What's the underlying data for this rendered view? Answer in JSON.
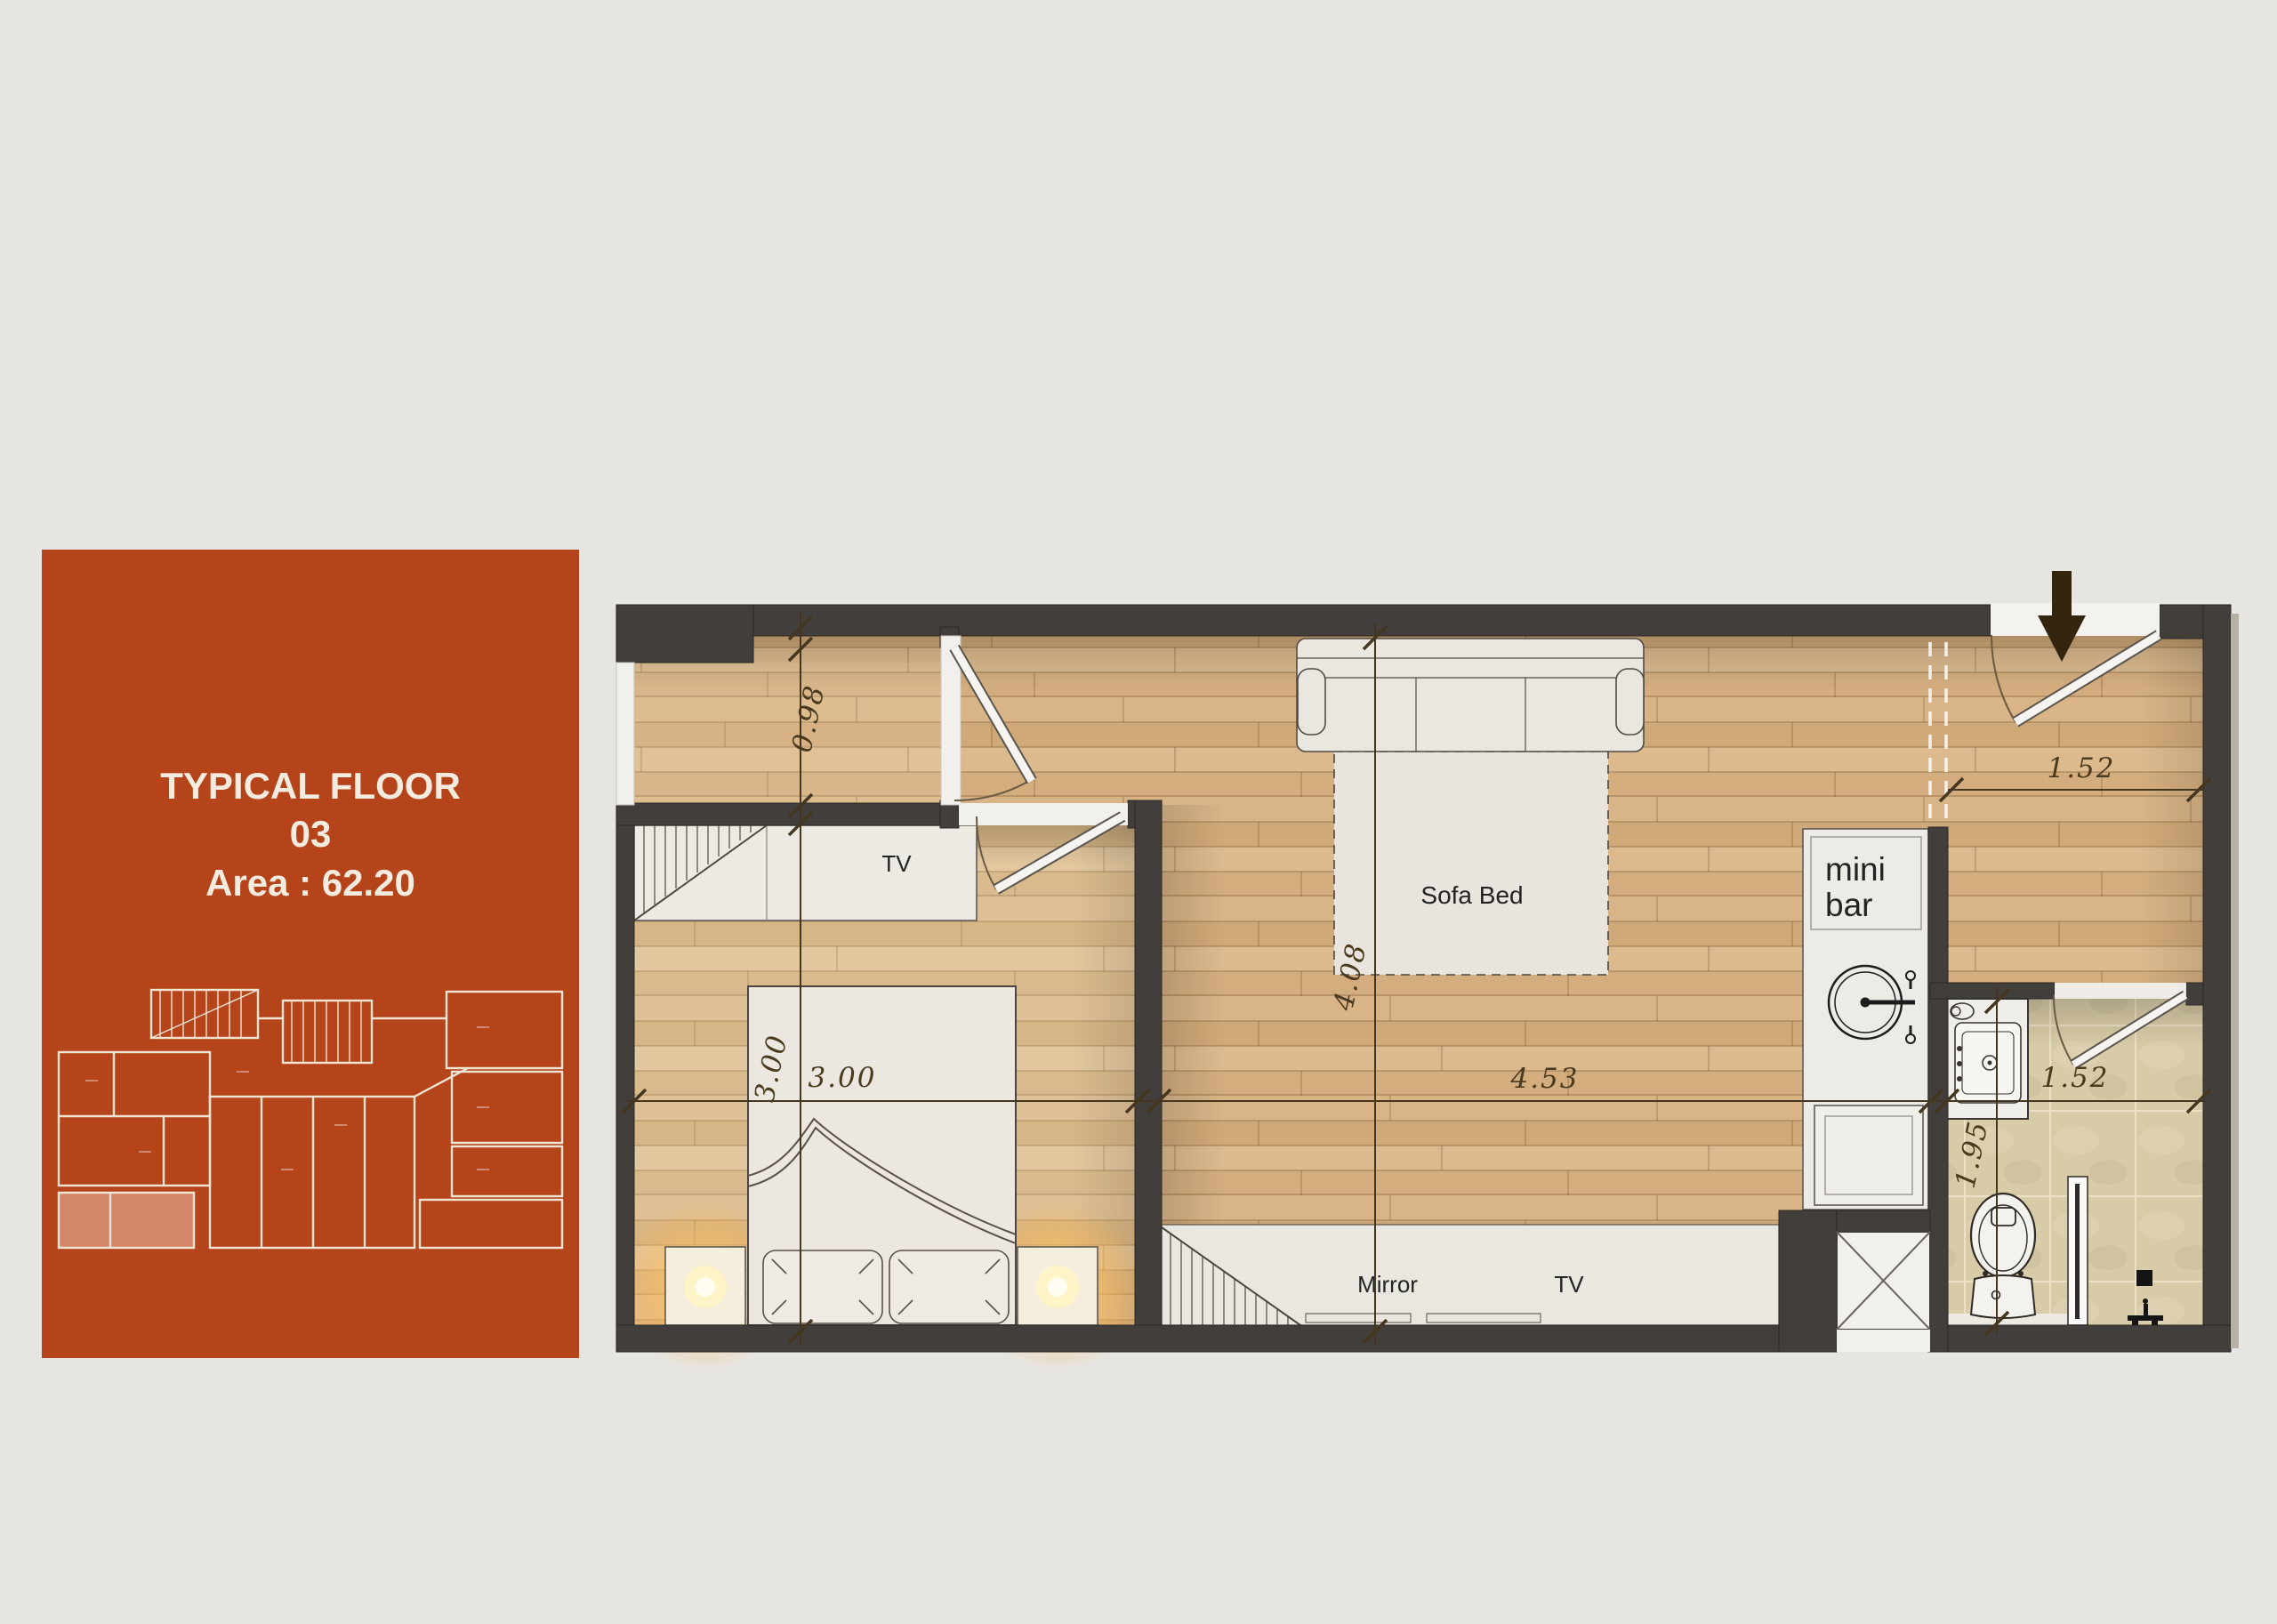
{
  "panel": {
    "title_line1": "TYPICAL FLOOR",
    "title_line2": "03",
    "title_line3": "Area : 62.20",
    "bg_color": "#b5441b",
    "text_color": "#f5ecdf"
  },
  "plan": {
    "labels": {
      "closet_tv": "TV",
      "sofa_bed": "Sofa Bed",
      "minibar_line1": "mini",
      "minibar_line2": "bar",
      "mirror": "Mirror",
      "console_tv": "TV"
    },
    "dimensions": {
      "hall_width": "0.98",
      "bedroom_width_vertical": "3.00",
      "bedroom_width_horizontal": "3.00",
      "living_width": "4.53",
      "living_depth": "4.08",
      "entry_width": "1.52",
      "bathroom_width": "1.52",
      "bathroom_depth": "1.95"
    },
    "colors": {
      "wall": "#413e3b",
      "wood": "#d6b083",
      "wood_light": "#dcbd92",
      "tile": "#d8cba7",
      "background": "#e7e5e2",
      "furniture": "#eceae4",
      "accent_panel": "#b5441b",
      "lamp_glow": "#ffd98a"
    }
  }
}
